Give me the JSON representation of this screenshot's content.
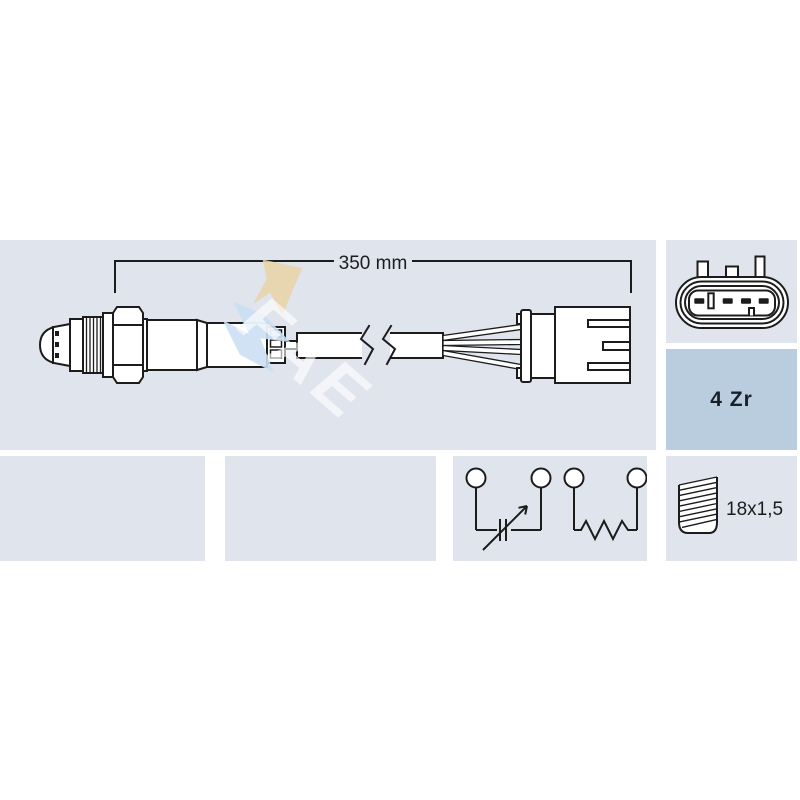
{
  "colors": {
    "background": "#ffffff",
    "panel_light": "#dfe4ed",
    "panel_accent": "#b9cdde",
    "line_art": "#1c1c1c",
    "watermark_tan": "#e9d3a3",
    "watermark_blue": "#cbdff2",
    "watermark_text": "rgba(255,255,255,0.62)"
  },
  "main_panel": {
    "dimension_label": "350 mm",
    "watermark": "FAE"
  },
  "specs": {
    "sensor_type_label": "4 Zr",
    "thread_label": "18x1,5"
  }
}
